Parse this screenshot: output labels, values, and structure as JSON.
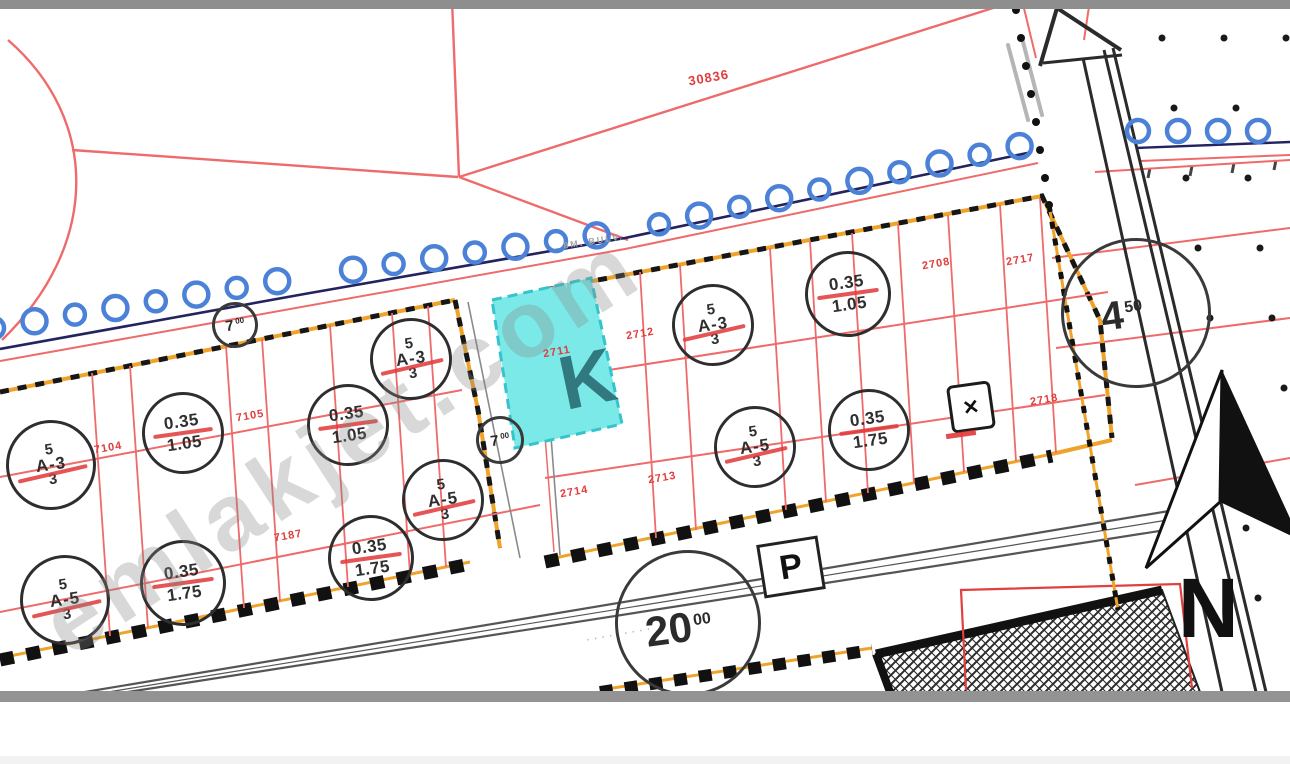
{
  "map": {
    "colors": {
      "map_red": "#ef6a6a",
      "parcel_text_red": "#e03c3c",
      "tree_blue": "#4b82d8",
      "boundary_orange": "#f0a32a",
      "cyan_fill": "#7ce9e9",
      "cyan_edge": "#35c4cc",
      "coast_navy": "#232360",
      "ink": "#222222"
    },
    "watermark": {
      "text": "emlakjet.com",
      "overlay_letter": "K"
    },
    "labels": {
      "north": "N",
      "parking": "P",
      "street_top": "8M. BULV.",
      "street_bottom_marks": "·········"
    },
    "trafo": {
      "icon": "✕"
    },
    "zoning_circles": [
      {
        "x": 48,
        "y": 462,
        "r": 42,
        "type": "storey",
        "top": "5",
        "mid": "A-3",
        "bot": "3"
      },
      {
        "x": 180,
        "y": 430,
        "r": 38,
        "type": "ratio",
        "top": "0.35",
        "bot": "1.05"
      },
      {
        "x": 345,
        "y": 422,
        "r": 38,
        "type": "ratio",
        "top": "0.35",
        "bot": "1.05"
      },
      {
        "x": 408,
        "y": 356,
        "r": 38,
        "type": "storey",
        "top": "5",
        "mid": "A-3",
        "bot": "3"
      },
      {
        "x": 62,
        "y": 597,
        "r": 42,
        "type": "storey",
        "top": "5",
        "mid": "A-5",
        "bot": "3"
      },
      {
        "x": 180,
        "y": 580,
        "r": 40,
        "type": "ratio",
        "top": "0.35",
        "bot": "1.75"
      },
      {
        "x": 368,
        "y": 555,
        "r": 40,
        "type": "ratio",
        "top": "0.35",
        "bot": "1.75"
      },
      {
        "x": 440,
        "y": 497,
        "r": 38,
        "type": "storey",
        "top": "5",
        "mid": "A-5",
        "bot": "3"
      },
      {
        "x": 710,
        "y": 322,
        "r": 38,
        "type": "storey",
        "top": "5",
        "mid": "A-3",
        "bot": "3"
      },
      {
        "x": 845,
        "y": 291,
        "r": 40,
        "type": "ratio",
        "top": "0.35",
        "bot": "1.05"
      },
      {
        "x": 752,
        "y": 444,
        "r": 38,
        "type": "storey",
        "top": "5",
        "mid": "A-5",
        "bot": "3"
      },
      {
        "x": 866,
        "y": 427,
        "r": 38,
        "type": "ratio",
        "top": "0.35",
        "bot": "1.75"
      }
    ],
    "road_width_circles": [
      {
        "x": 685,
        "y": 620,
        "r": 70,
        "main": "20",
        "sup": "00",
        "fs": 42,
        "sfs": 16,
        "dx": -10,
        "dy": 4
      },
      {
        "x": 1133,
        "y": 310,
        "r": 72,
        "main": "4",
        "sup": "50",
        "fs": 40,
        "sfs": 16,
        "dx": -14,
        "dy": 0
      },
      {
        "x": 232,
        "y": 322,
        "r": 20,
        "main": "7",
        "sup": "00",
        "fs": 15,
        "sfs": 8,
        "dx": 0,
        "dy": 0
      },
      {
        "x": 497,
        "y": 437,
        "r": 21,
        "main": "7",
        "sup": "00",
        "fs": 15,
        "sfs": 8,
        "dx": 0,
        "dy": 0
      }
    ],
    "parcel_numbers": [
      {
        "t": "30836",
        "x": 688,
        "y": 70,
        "fs": 13
      },
      {
        "t": "7104",
        "x": 94,
        "y": 442,
        "fs": 11
      },
      {
        "t": "7105",
        "x": 236,
        "y": 410,
        "fs": 11
      },
      {
        "t": "7187",
        "x": 274,
        "y": 530,
        "fs": 11
      },
      {
        "t": "2711",
        "x": 543,
        "y": 346,
        "fs": 11
      },
      {
        "t": "2712",
        "x": 626,
        "y": 328,
        "fs": 11
      },
      {
        "t": "2714",
        "x": 560,
        "y": 486,
        "fs": 11
      },
      {
        "t": "2713",
        "x": 648,
        "y": 472,
        "fs": 11
      },
      {
        "t": "2708",
        "x": 922,
        "y": 258,
        "fs": 11
      },
      {
        "t": "2717",
        "x": 1006,
        "y": 254,
        "fs": 11
      },
      {
        "t": "2718",
        "x": 1030,
        "y": 394,
        "fs": 11
      }
    ],
    "subject_parcel": {
      "number": "2711",
      "highlight": "cyan"
    }
  }
}
